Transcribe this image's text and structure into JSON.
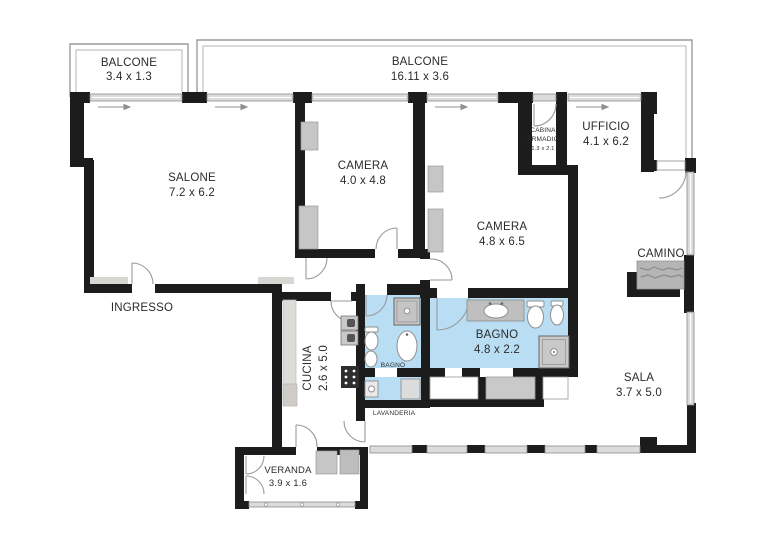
{
  "floorplan": {
    "rooms": {
      "balcone_left": {
        "label": "BALCONE",
        "dims": "3.4 x 1.3"
      },
      "balcone_top": {
        "label": "BALCONE",
        "dims": "16.11 x 3.6"
      },
      "salone": {
        "label": "SALONE",
        "dims": "7.2 x 6.2"
      },
      "ingresso": {
        "label": "INGRESSO"
      },
      "camera_1": {
        "label": "CAMERA",
        "dims": "4.0 x 4.8"
      },
      "camera_2": {
        "label": "CAMERA",
        "dims": "4.8 x 6.5"
      },
      "cabina_armadio": {
        "label_line1": "CABINA",
        "label_line2": "ARMADIO",
        "dims": "1.3 x 2.1"
      },
      "ufficio": {
        "label": "UFFICIO",
        "dims": "4.1 x 6.2"
      },
      "camino": {
        "label": "CAMINO"
      },
      "cucina": {
        "label": "CUCINA",
        "dims": "2.6 x 5.0"
      },
      "bagno_piccolo": {
        "label": "BAGNO"
      },
      "bagno_grande": {
        "label": "BAGNO",
        "dims": "4.8 x 2.2"
      },
      "lavanderia": {
        "label": "LAVANDERIA"
      },
      "sala": {
        "label": "SALA",
        "dims": "3.7 x 5.0"
      },
      "veranda": {
        "label": "VERANDA",
        "dims": "3.9 x 1.6"
      }
    },
    "colors": {
      "wall": "#1c1c1c",
      "bathroom_floor": "#b9ddf2",
      "window": "#dcdcdc",
      "furniture": "#c6c6c6",
      "text": "#2b2b2b"
    }
  }
}
